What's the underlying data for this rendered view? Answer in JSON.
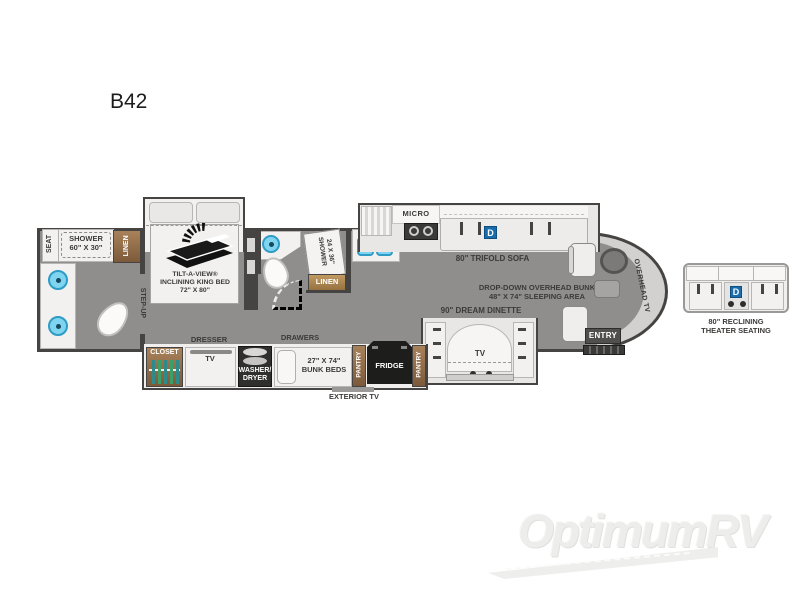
{
  "page": {
    "title": "B42"
  },
  "watermark": {
    "brand": "OptimumRV"
  },
  "rear_bath": {
    "seat": "SEAT",
    "shower_title": "SHOWER",
    "shower_size": "60\" X 30\"",
    "linen": "LINEN",
    "step_up": "STEP-UP"
  },
  "bedroom": {
    "bed_line1": "TILT-A-VIEW®",
    "bed_line2": "INCLINING KING BED",
    "bed_line3": "72\" X 80\"",
    "closet": "CLOSET",
    "dresser": "DRESSER",
    "tv": "TV",
    "washer_line1": "WASHER/",
    "washer_line2": "DRYER"
  },
  "mid_bath": {
    "shower_title": "SHOWER",
    "shower_size": "24 X 36\"",
    "linen": "LINEN"
  },
  "bunk_area": {
    "drawers": "DRAWERS",
    "bunk_size": "27\" X 74\"",
    "bunk_name": "BUNK BEDS",
    "pantry": "PANTRY",
    "fridge": "FRIDGE",
    "exterior_tv": "EXTERIOR TV"
  },
  "kitchen": {
    "micro": "MICRO"
  },
  "living": {
    "sofa": "80\" TRIFOLD SOFA",
    "dropdown_line1": "DROP-DOWN OVERHEAD BUNK",
    "dropdown_line2": "48\" X 74\" SLEEPING AREA",
    "dinette": "90\" DREAM DINETTE",
    "dinette_tv": "TV",
    "d_badge": "D"
  },
  "front": {
    "overhead_tv": "OVERHEAD TV",
    "entry": "ENTRY"
  },
  "theater": {
    "label_line1": "80\" RECLINING",
    "label_line2": "THEATER SEATING",
    "d_badge": "D"
  },
  "colors": {
    "accent_blue": "#1a6dad",
    "sink_blue": "#7fd4ef",
    "wood_brown": "#8a6a4a",
    "floor_gray": "#8f8e8c",
    "wall_dark": "#454442"
  }
}
